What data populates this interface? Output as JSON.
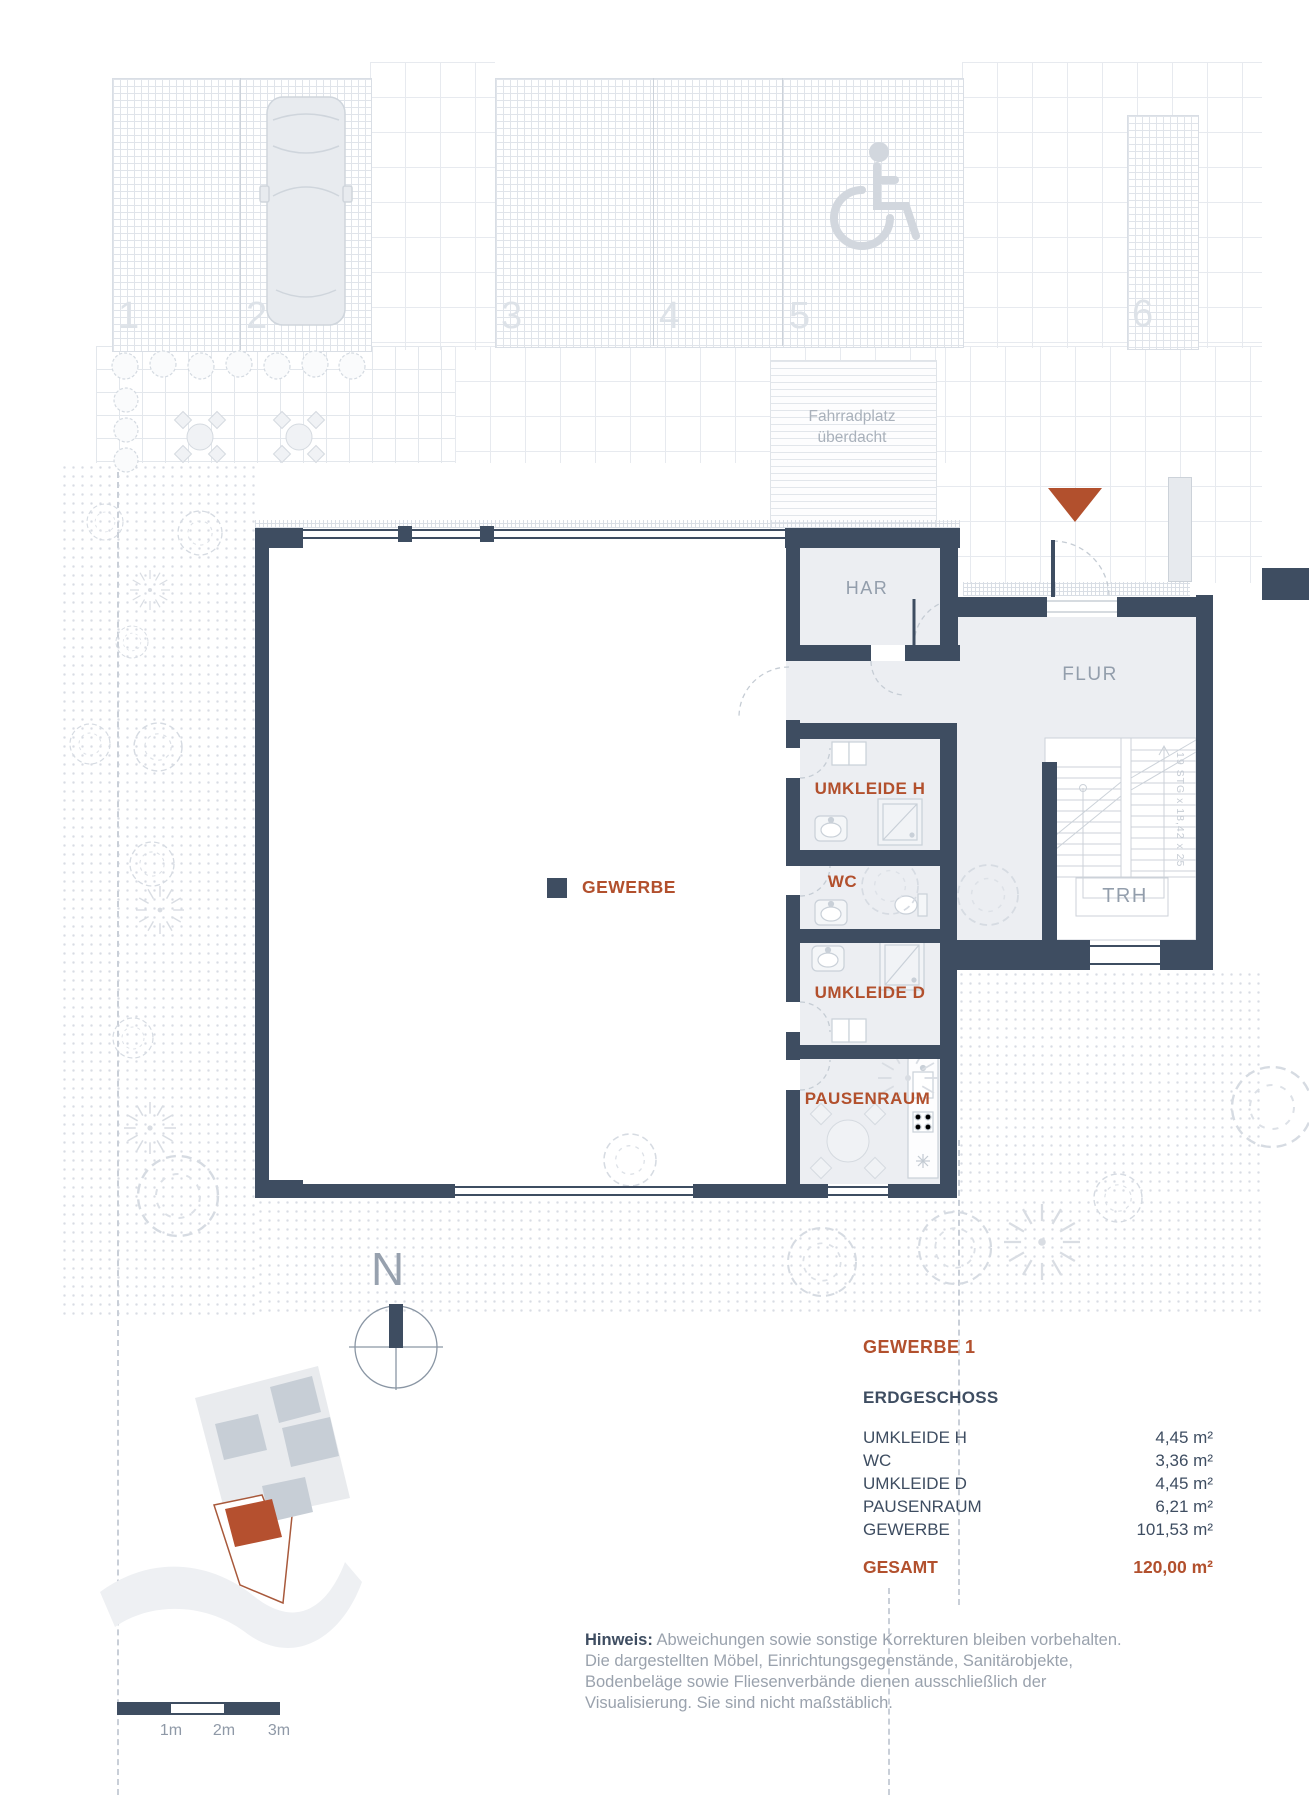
{
  "colors": {
    "wall": "#3e4d61",
    "accent": "#b2502d",
    "room_fill": "#eceef2",
    "label_gray": "#939eac",
    "note_gray": "#9aa2ad"
  },
  "plan": {
    "rooms": {
      "har": "HAR",
      "flur": "FLUR",
      "trh": "TRH",
      "umkleide_h": "UMKLEIDE H",
      "wc": "WC",
      "umkleide_d": "UMKLEIDE D",
      "pausenraum": "PAUSENRAUM",
      "gewerbe": "GEWERBE"
    },
    "stair_note": "19 STG x 18,42 x 25"
  },
  "site": {
    "parking_numbers": [
      "1",
      "2",
      "3",
      "4",
      "5",
      "6"
    ],
    "bike_shelter": {
      "line1": "Fahrradplatz",
      "line2": "überdacht"
    },
    "compass_label": "N"
  },
  "legend": {
    "title": "GEWERBE 1",
    "floor": "ERDGESCHOSS",
    "rooms": [
      {
        "name": "UMKLEIDE H",
        "area": "4,45 m²"
      },
      {
        "name": "WC",
        "area": "3,36 m²"
      },
      {
        "name": "UMKLEIDE D",
        "area": "4,45 m²"
      },
      {
        "name": "PAUSENRAUM",
        "area": "6,21 m²"
      },
      {
        "name": "GEWERBE",
        "area": "101,53 m²"
      }
    ],
    "total": {
      "label": "GESAMT",
      "area": "120,00 m²"
    }
  },
  "note": {
    "label": "Hinweis:",
    "text": " Abweichungen sowie sonstige Korrekturen bleiben vorbehalten. Die dargestellten Möbel, Einrichtungsgegenstände, Sanitärobjekte, Bodenbeläge sowie Fliesenverbände dienen ausschließlich der Visualisierung. Sie sind nicht maßstäblich."
  },
  "scalebar": {
    "labels": [
      "1m",
      "2m",
      "3m"
    ]
  }
}
